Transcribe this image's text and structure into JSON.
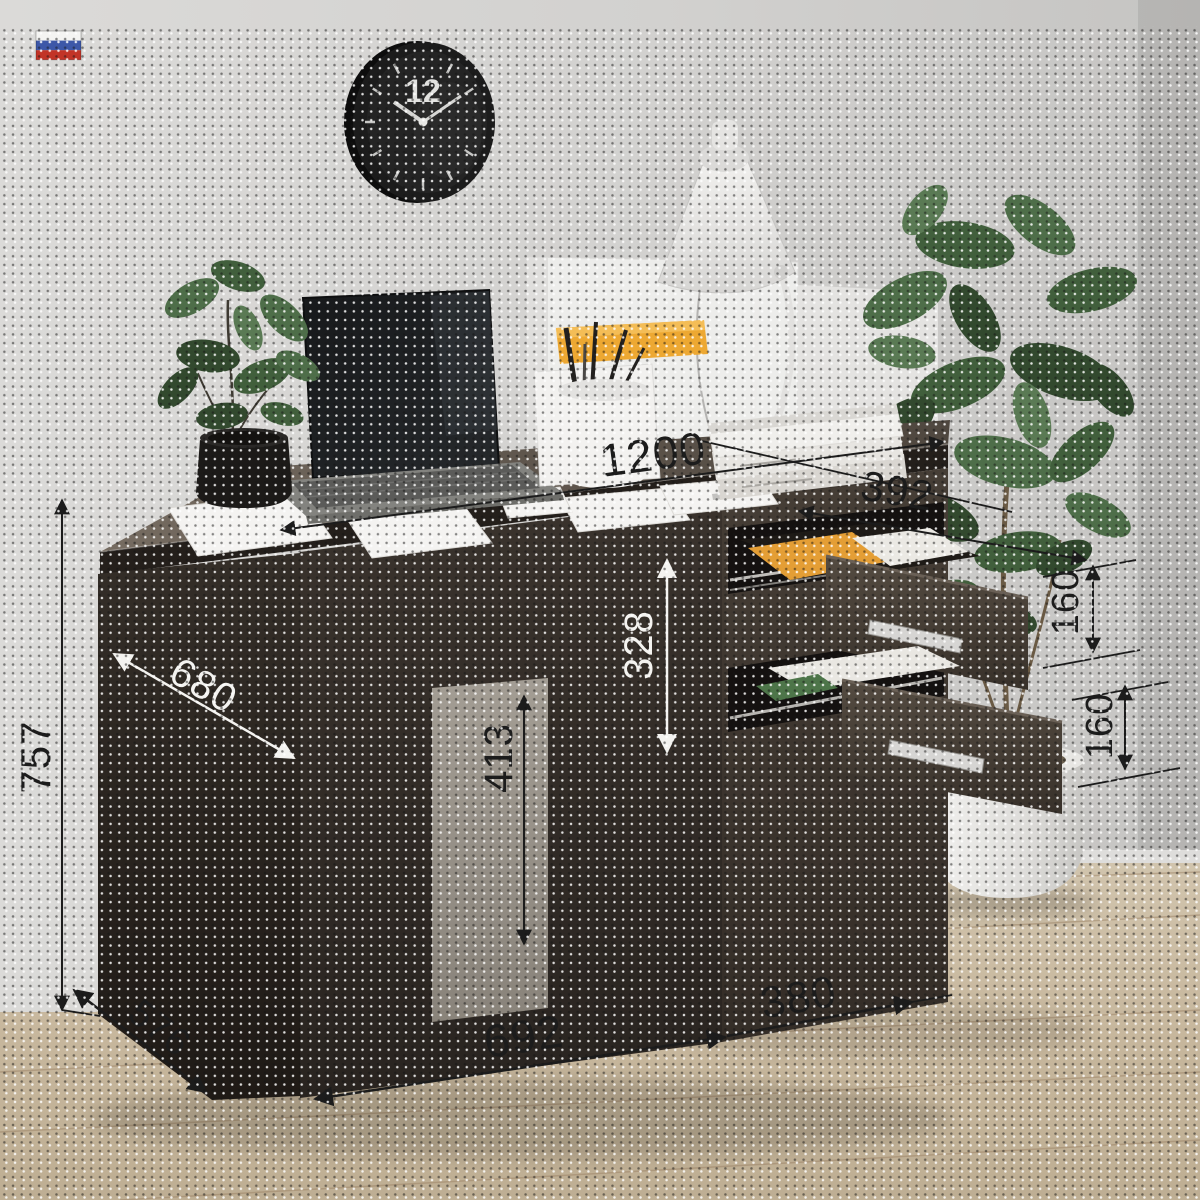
{
  "flag": {
    "country": "russia",
    "stripes": [
      "#f4f4f2",
      "#3d58a8",
      "#c23427"
    ]
  },
  "clock": {
    "numeral": "12"
  },
  "dimensions": {
    "desktop_width": "1200",
    "pedestal_depth": "392",
    "desktop_side_depth": "680",
    "overall_height": "757",
    "upper_clearance": "328",
    "lower_clearance": "413",
    "top_drawer_height": "160",
    "bottom_drawer_height": "160",
    "kneehole_width": "692",
    "pedestal_width": "380",
    "base_side_depth": "576"
  },
  "palette": {
    "dimension_dark": "#1c1c1c",
    "dimension_light": "#f4f3f0",
    "folder_orange": "#e49e35",
    "notebook_orange": "#eda832",
    "handle_silver": "#d6d5d3",
    "wall": "#d3d2d0",
    "floor": "#c9bba2",
    "desk_dark": "#332c26"
  }
}
